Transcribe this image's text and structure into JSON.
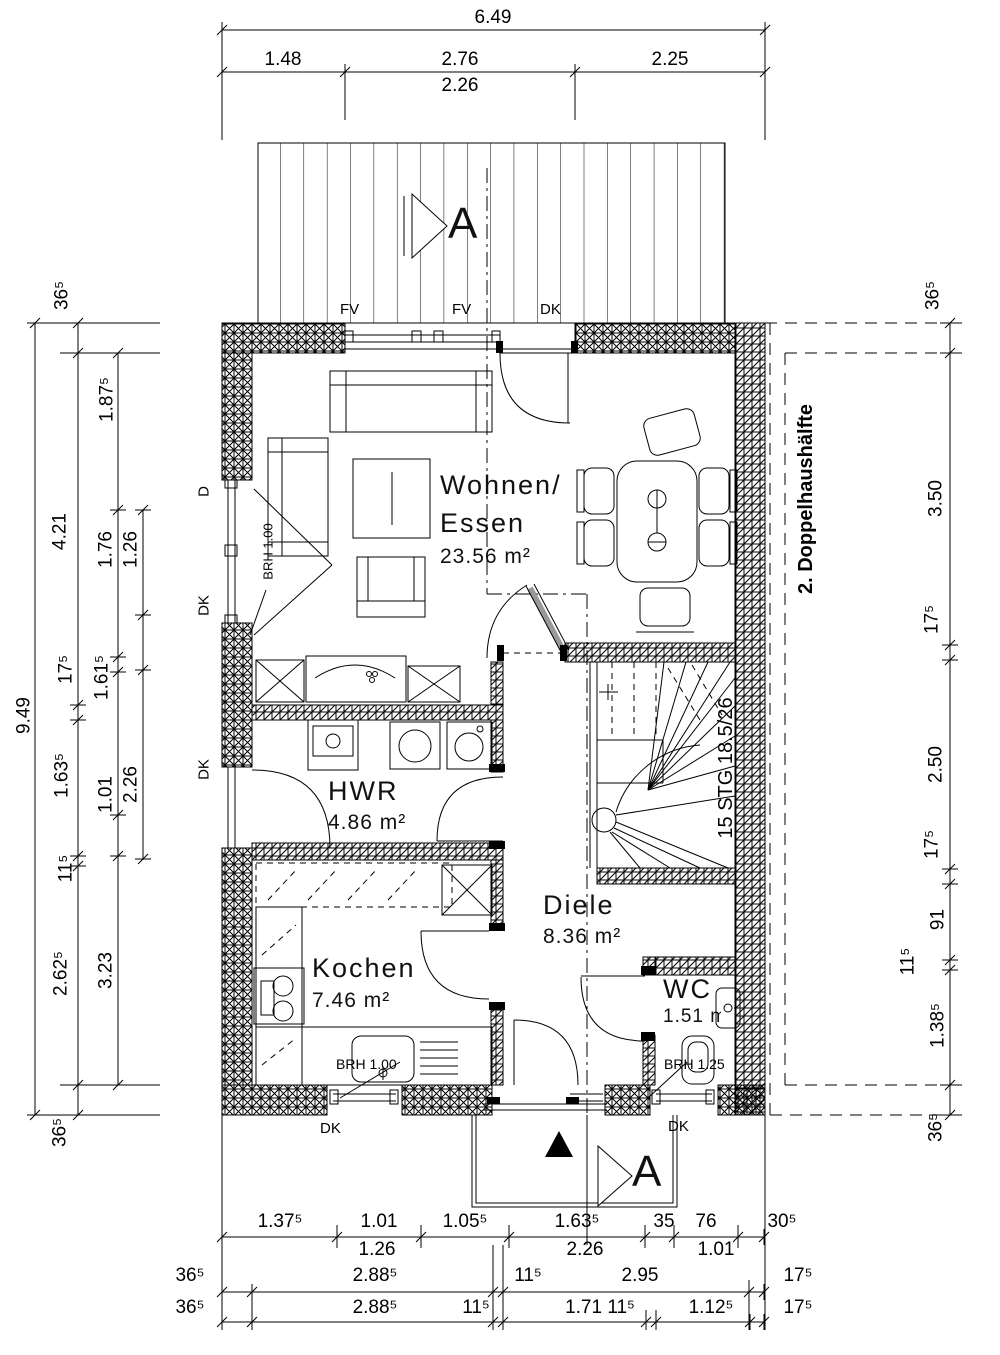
{
  "drawing": {
    "rooms": {
      "wohnen": {
        "line1": "Wohnen/",
        "line2": "Essen",
        "area": "23.56 m²"
      },
      "hwr": {
        "name": "HWR",
        "area": "4.86 m²"
      },
      "kochen": {
        "name": "Kochen",
        "area": "7.46 m²"
      },
      "diele": {
        "name": "Diele",
        "area": "8.36 m²"
      },
      "wc": {
        "name": "WC",
        "area": "1.51 m²"
      }
    },
    "stairs_label": "15 STG 18.5/26",
    "annex_label": "2. Doppelhaushälfte",
    "section_marker": "A",
    "window_labels": {
      "top_fv_left": "FV",
      "top_fv_right": "FV",
      "top_dk": "DK",
      "left_d": "D",
      "left_dk_upper": "DK",
      "left_dk_lower": "DK",
      "left_brh": "BRH 1.00",
      "kitchen_brh": "BRH 1.00",
      "kitchen_dk": "DK",
      "wc_brh": "BRH 1.25",
      "wc_dk": "DK"
    },
    "dims": {
      "top": [
        "6.49",
        "1.48",
        "2.76",
        "2.25",
        "2.26"
      ],
      "left": [
        "36⁵",
        "1.87⁵",
        "4.21",
        "1.76",
        "1.26",
        "9.49",
        "17⁵",
        "1.61⁵",
        "1.63⁵",
        "1.01",
        "2.26",
        "11⁵",
        "2.62⁵",
        "3.23",
        "36⁵"
      ],
      "right": [
        "36⁵",
        "3.50",
        "17⁵",
        "2.50",
        "17⁵",
        "91",
        "11⁵",
        "1.38⁵",
        "36⁵"
      ],
      "bottom1": [
        "1.37⁵",
        "1.01",
        "1.05⁵",
        "1.63⁵",
        "35",
        "76",
        "30⁵"
      ],
      "bottom2": [
        "1.26",
        "2.26",
        "1.01"
      ],
      "bottom3": [
        "36⁵",
        "2.88⁵",
        "11⁵",
        "2.95",
        "17⁵"
      ],
      "bottom4": [
        "36⁵",
        "2.88⁵",
        "11⁵",
        "1.71 11⁵",
        "1.12⁵",
        "17⁵"
      ]
    },
    "colors": {
      "wall": "#f80000",
      "line": "#000000"
    }
  }
}
